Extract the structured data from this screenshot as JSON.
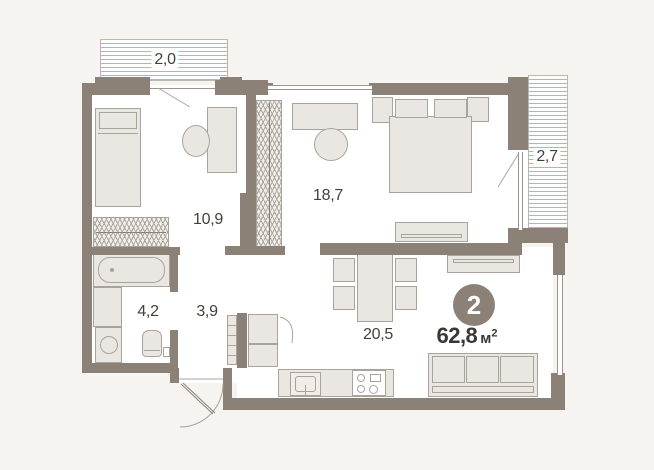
{
  "floorplan": {
    "badge_rooms": "2",
    "total": {
      "value": "62,8",
      "unit": "м",
      "sup": "2"
    },
    "areas": {
      "balcony_top": "2,0",
      "bedroom_small": "10,9",
      "bedroom_master": "18,7",
      "balcony_right": "2,7",
      "bathroom": "4,2",
      "hallway": "3,9",
      "living_kitchen": "20,5"
    },
    "colors": {
      "wall": "#8b8177",
      "furniture_fill": "#eae7e2",
      "furniture_border": "#a9a39b",
      "balcony_hatch": "#eb9e91",
      "text": "#45403a",
      "badge_background": "#8b8177",
      "badge_text": "#ffffff",
      "room_background": "#ffffff",
      "outside_background": "#f6f4f1"
    }
  }
}
